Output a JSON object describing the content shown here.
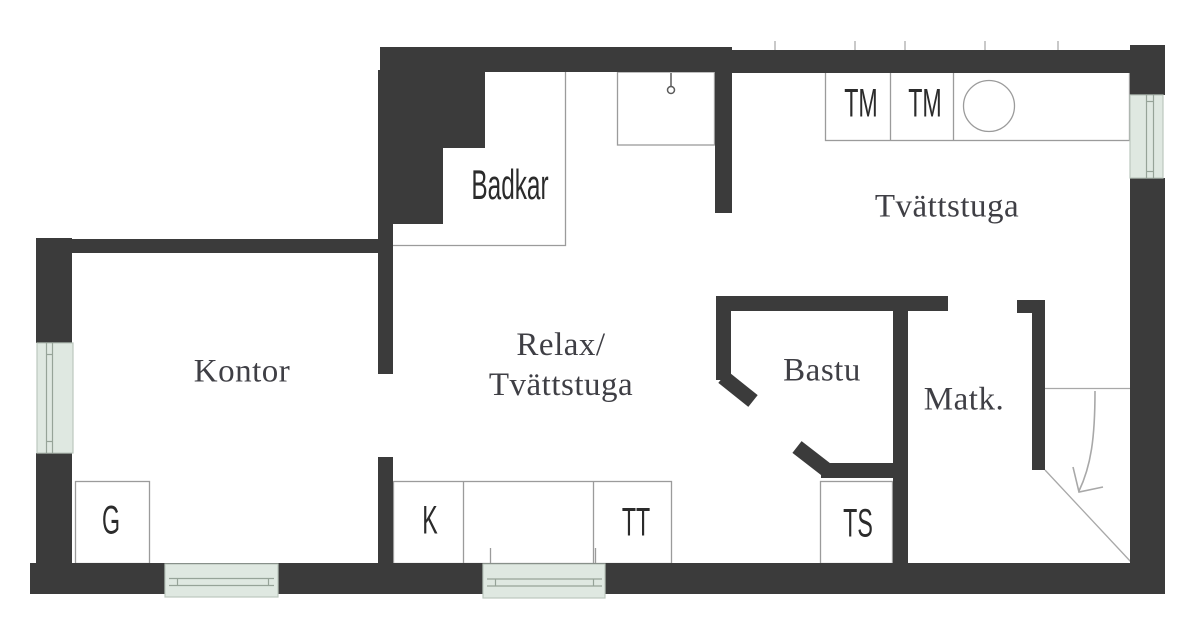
{
  "colors": {
    "wall": "#3b3b3b",
    "line": "#9b9b9b",
    "faint": "#c9c9c9",
    "stair_line": "#a8a8a8",
    "icon_stroke": "#5a5a5a",
    "window_fill": "#dfe8e1",
    "window_line": "#96a398",
    "window_border": "#bcc7bd",
    "room_text": "#3f3f45",
    "label_text": "#2b2b2b"
  },
  "rooms": {
    "kontor": {
      "label": "Kontor"
    },
    "relax": {
      "line1": "Relax/",
      "line2": "Tvättstuga"
    },
    "tvattstuga": {
      "label": "Tvättstuga"
    },
    "bastu": {
      "label": "Bastu"
    },
    "matk": {
      "label": "Matk."
    },
    "badkar": {
      "label": "Badkar"
    }
  },
  "fixtures": {
    "g": "G",
    "k": "K",
    "tt": "TT",
    "ts": "TS",
    "tm1": "TM",
    "tm2": "TM"
  },
  "icons": {
    "shower": "shower-head-icon",
    "sink": "sink-basin-icon",
    "stairs_arrow": "stairs-down-arrow-icon"
  }
}
